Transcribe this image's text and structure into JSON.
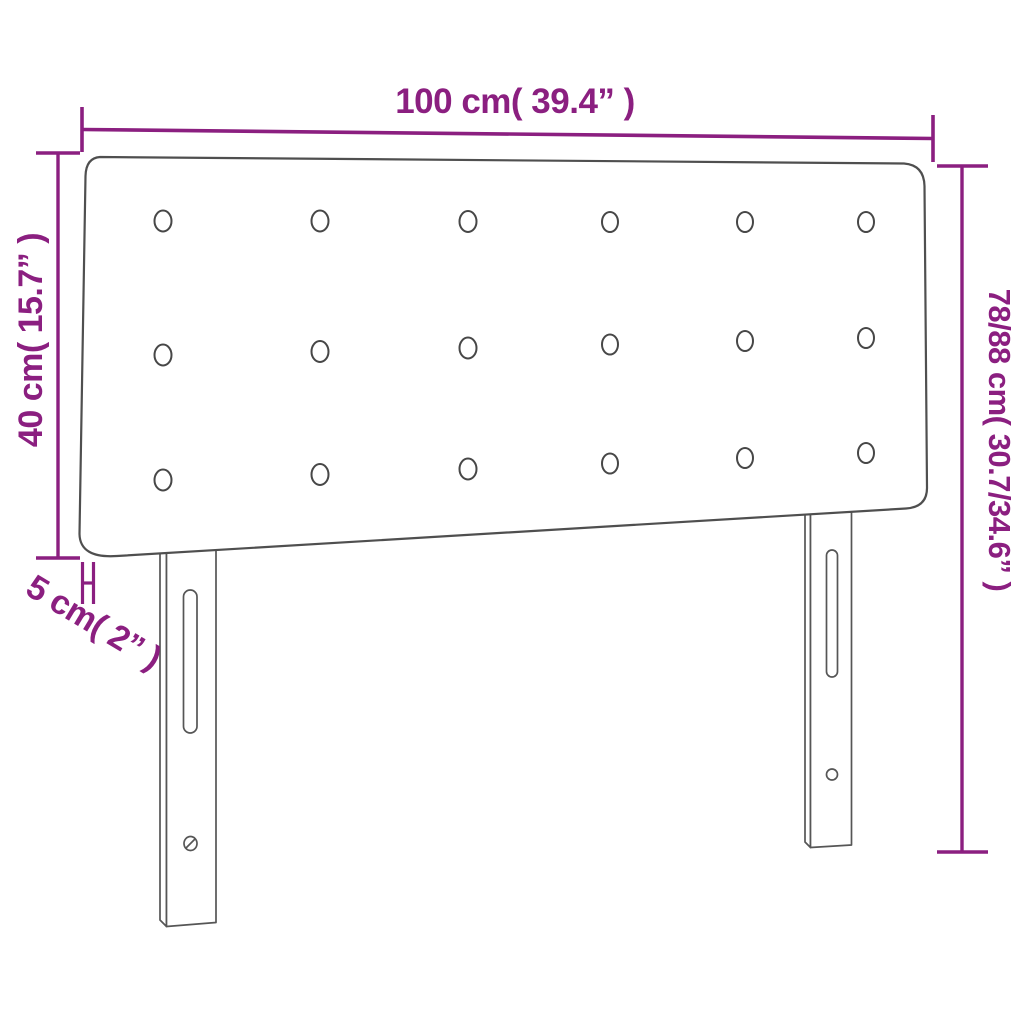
{
  "diagram": {
    "type": "product-dimension-diagram",
    "subject": "button-tufted headboard with two slotted legs",
    "labels": {
      "width": "100 cm( 39.4” )",
      "headboard_height": "40 cm( 15.7” )",
      "thickness": "5 cm( 2” )",
      "total_height": "78/88 cm( 30.7/34.6” )"
    },
    "colors": {
      "dimension": "#8b1f80",
      "outline": "#4f4f4f",
      "background": "#ffffff"
    },
    "buttons": {
      "rows": 3,
      "columns": 6,
      "count": 18
    }
  }
}
